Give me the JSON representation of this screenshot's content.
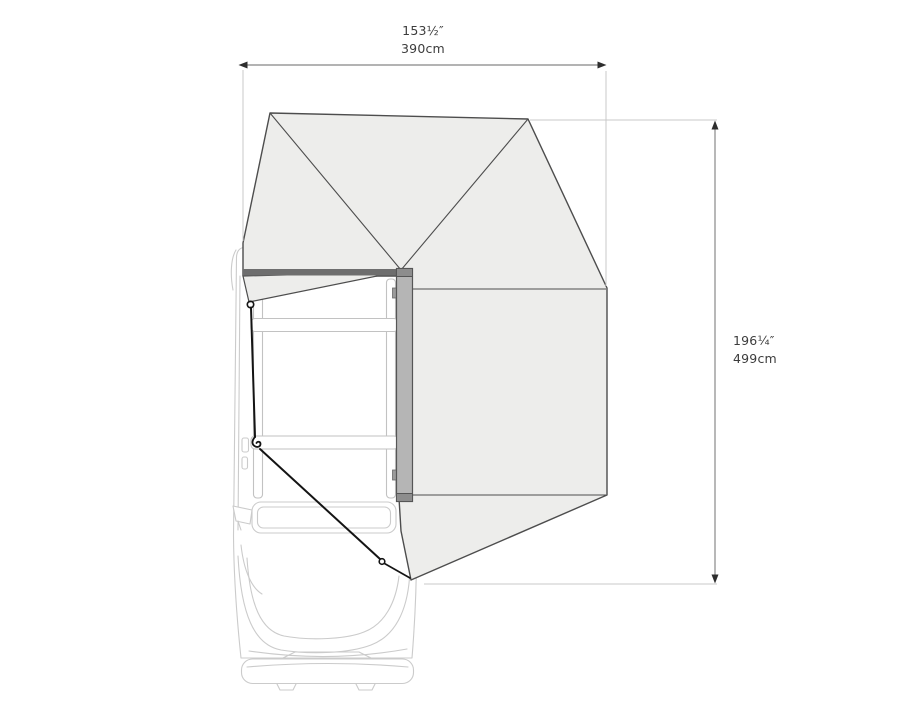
{
  "diagram": {
    "type": "top-view product dimension diagram",
    "subject": "vehicle seen from above with a 270-degree side awning deployed, secured by two guy ropes",
    "width_label": {
      "imperial": "153½″",
      "metric": "390cm"
    },
    "height_label": {
      "imperial": "196¼″",
      "metric": "499cm"
    },
    "parts": [
      "vehicle-top-view",
      "roof-rack",
      "awning-fabric-fan",
      "awning-room-panel",
      "mounting-bracket",
      "guy-ropes-with-hooks",
      "dimension-lines"
    ],
    "colors": {
      "fabric_fill": "#ededeb",
      "fabric_outline": "#4d4d4d",
      "bracket_fill": "#b5b5b5",
      "bracket_cap": "#8d8d8d",
      "roof_mount_bar": "#6e6e6e",
      "vehicle_line": "#cbcbcb",
      "dimension_line": "#9a9a9a",
      "extension_line": "#c9c9c9",
      "rope": "#141414",
      "text": "#3c3c3c",
      "background": "#ffffff"
    }
  }
}
